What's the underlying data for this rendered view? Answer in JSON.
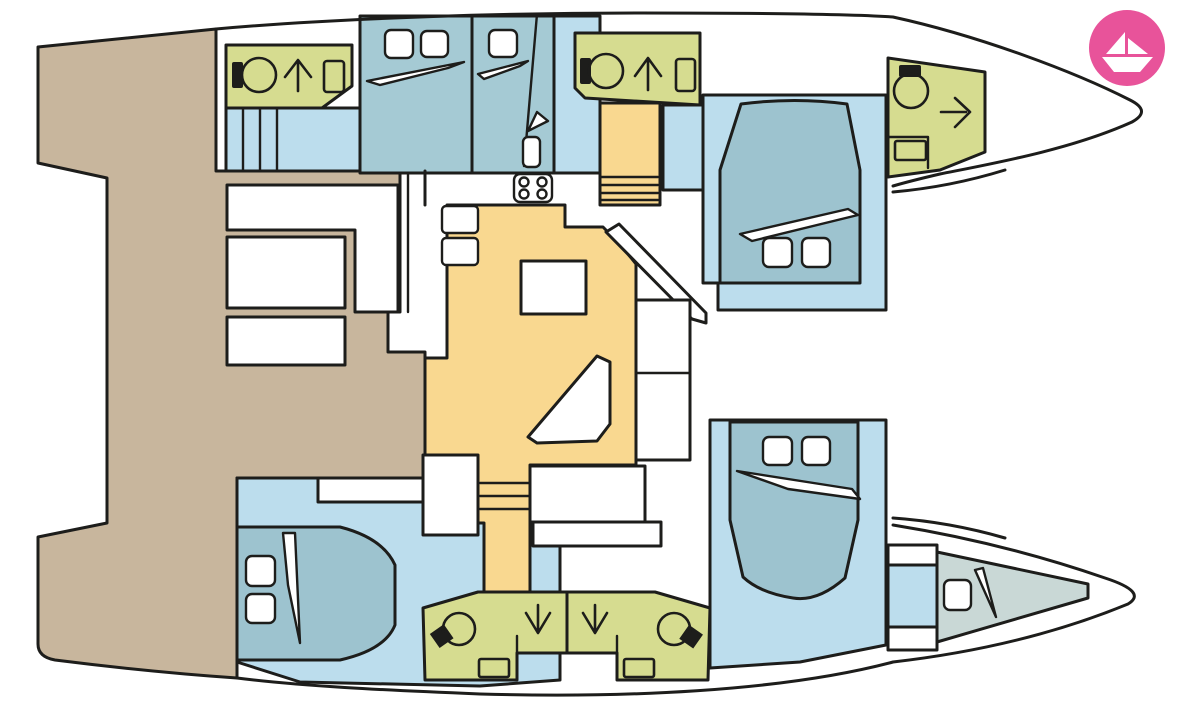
{
  "title": "catamaran-interior-deck-plan",
  "colors": {
    "outline": "#1d1d1b",
    "white": "#ffffff",
    "cockpit": "#c8b69d",
    "floor": "#bcdded",
    "cabin": "#a5cad4",
    "bed": "#9dc3cf",
    "berth": "#c9d8d6",
    "bathroom": "#d6dc90",
    "saloon": "#f9d890",
    "logo_pink": "#e8539a",
    "logo_white": "#ffffff"
  },
  "icons": [
    "toilet-icon",
    "shower-arrow-up-icon",
    "shower-arrow-right-icon",
    "shower-arrow-down-icon",
    "sink-icon",
    "stove-icon",
    "bed-pillow-icon",
    "bed-fold-icon",
    "stairs-icon",
    "paper-boat-logo"
  ],
  "logo": {
    "shape": "paper-boat",
    "alt": "boat rental brand mark"
  }
}
